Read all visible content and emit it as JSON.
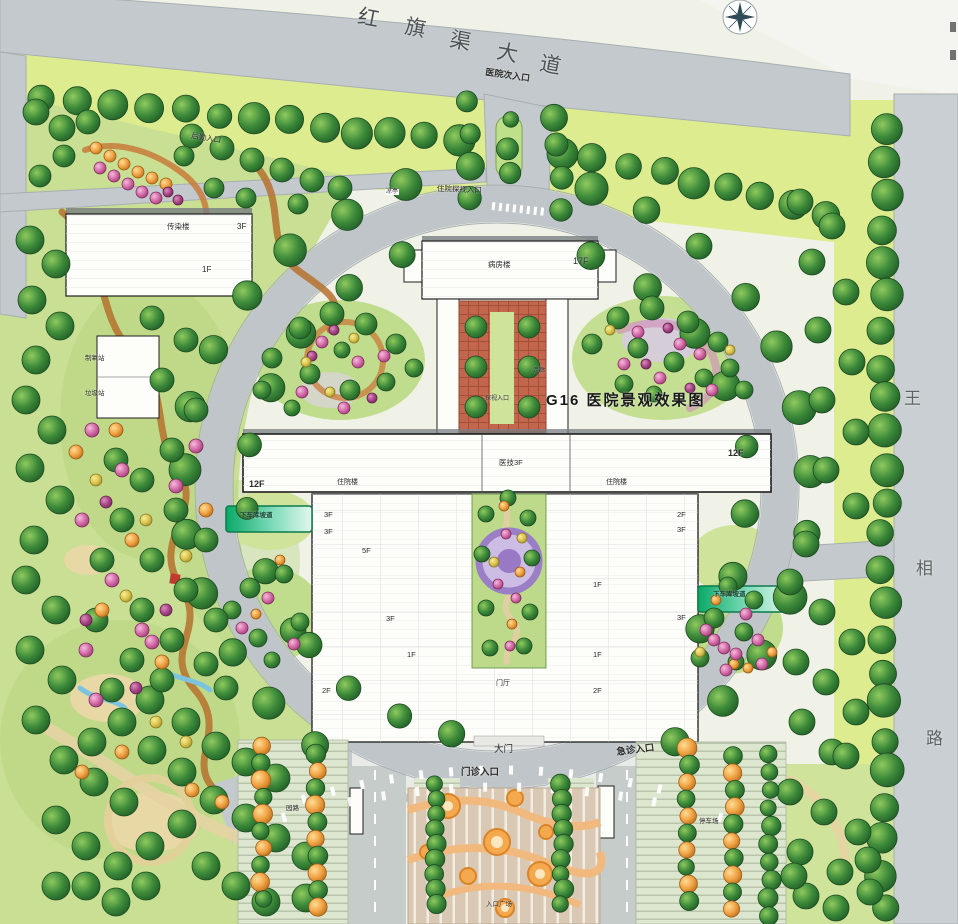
{
  "plan": {
    "watermark_text": "G16 医院景观效果图",
    "north_road_name": "红旗渠大道",
    "east_road_name": "王相路"
  },
  "icons": [
    {
      "name": "compass-rose-icon"
    },
    {
      "name": "tree-icon"
    },
    {
      "name": "shrub-icon"
    }
  ],
  "colors": {
    "lawn": "#ddec8e",
    "park_green": "#c9df93",
    "road_grey": "#c3c9cc",
    "ring_grey": "#bfc5c8",
    "courtyard_terracotta": "#c2674d",
    "ramp_teal": "#0aa968",
    "tree_green": "#3d8a3a",
    "tree_orange": "#f0a244",
    "shrub_pink": "#d46aa8",
    "feature_purple": "#9a7fc6",
    "plaza_tan": "#d9c9b4"
  },
  "labels": {
    "road_names": [
      {
        "id": "hongqiqu-char-1",
        "t": "红",
        "x": 360,
        "y": 6,
        "fs": 21,
        "rot": 11,
        "c": "#4c5155"
      },
      {
        "id": "hongqiqu-char-2",
        "t": "旗",
        "x": 407,
        "y": 16,
        "fs": 21,
        "rot": 11,
        "c": "#4c5155"
      },
      {
        "id": "hongqiqu-char-3",
        "t": "渠",
        "x": 452,
        "y": 29,
        "fs": 21,
        "rot": 11,
        "c": "#4c5155"
      },
      {
        "id": "hongqiqu-char-4",
        "t": "大",
        "x": 499,
        "y": 41,
        "fs": 21,
        "rot": 11,
        "c": "#4c5155"
      },
      {
        "id": "hongqiqu-char-5",
        "t": "道",
        "x": 542,
        "y": 53,
        "fs": 21,
        "rot": 11,
        "c": "#4c5155"
      },
      {
        "id": "wangxiang-char-1",
        "t": "王",
        "x": 904,
        "y": 390,
        "fs": 17,
        "c": "#5d6266"
      },
      {
        "id": "wangxiang-char-2",
        "t": "相",
        "x": 916,
        "y": 560,
        "fs": 17,
        "c": "#5d6266"
      },
      {
        "id": "wangxiang-char-3",
        "t": "路",
        "x": 926,
        "y": 730,
        "fs": 17,
        "c": "#5d6266"
      }
    ],
    "entrances": [
      {
        "id": "hospital-secondary-entrance",
        "t": "医院次入口",
        "x": 486,
        "y": 68,
        "fs": 9,
        "rot": 8,
        "b": 1
      },
      {
        "id": "inpatient-visit-entrance",
        "t": "住院探视入口",
        "x": 437,
        "y": 185,
        "fs": 7.5,
        "rot": 2
      },
      {
        "id": "service-entrance",
        "t": "后勤入口",
        "x": 192,
        "y": 132,
        "fs": 7.5,
        "rot": 9
      },
      {
        "id": "main-gate",
        "t": "大门",
        "x": 494,
        "y": 745,
        "fs": 9.5
      },
      {
        "id": "outpatient-entrance",
        "t": "门诊入口",
        "x": 461,
        "y": 768,
        "fs": 9.5,
        "b": 1
      },
      {
        "id": "emergency-entrance",
        "t": "急诊入口",
        "x": 616,
        "y": 748,
        "fs": 9.5,
        "rot": -7,
        "b": 1
      },
      {
        "id": "courtyard-visit-entrance",
        "t": "探视入口",
        "x": 485,
        "y": 396,
        "fs": 6
      }
    ],
    "buildings": [
      {
        "id": "infectious-building",
        "t": "传染楼",
        "x": 167,
        "y": 223,
        "fs": 7.5
      },
      {
        "id": "infectious-floors",
        "t": "3F",
        "x": 237,
        "y": 223,
        "fs": 8
      },
      {
        "id": "infectious-floors-b",
        "t": "1F",
        "x": 202,
        "y": 266,
        "fs": 8
      },
      {
        "id": "oxygen-station",
        "t": "制氧站",
        "x": 85,
        "y": 356,
        "fs": 6.5
      },
      {
        "id": "garbage-station",
        "t": "垃圾站",
        "x": 85,
        "y": 391,
        "fs": 6.5
      },
      {
        "id": "ward-tower",
        "t": "病房楼",
        "x": 488,
        "y": 261,
        "fs": 7.5
      },
      {
        "id": "ward-tower-floors",
        "t": "17F",
        "x": 573,
        "y": 257,
        "fs": 9
      },
      {
        "id": "corridor",
        "t": "连廊",
        "x": 533,
        "y": 368,
        "fs": 6
      },
      {
        "id": "west-wing-floors",
        "t": "12F",
        "x": 249,
        "y": 480,
        "fs": 9,
        "b": 1
      },
      {
        "id": "inpatient-west",
        "t": "住院楼",
        "x": 337,
        "y": 479,
        "fs": 7
      },
      {
        "id": "medtech-block",
        "t": "医技3F",
        "x": 499,
        "y": 459,
        "fs": 7.5
      },
      {
        "id": "inpatient-east",
        "t": "住院楼",
        "x": 606,
        "y": 479,
        "fs": 7
      },
      {
        "id": "east-wing-floors",
        "t": "12F",
        "x": 728,
        "y": 449,
        "fs": 9,
        "b": 1
      },
      {
        "id": "entry-hall",
        "t": "门厅",
        "x": 496,
        "y": 680,
        "fs": 7
      }
    ],
    "floors": [
      {
        "t": "3F",
        "x": 324,
        "y": 511,
        "fs": 7.5
      },
      {
        "t": "3F",
        "x": 324,
        "y": 528,
        "fs": 7.5
      },
      {
        "t": "5F",
        "x": 362,
        "y": 547,
        "fs": 7.5
      },
      {
        "t": "3F",
        "x": 386,
        "y": 615,
        "fs": 7.5
      },
      {
        "t": "1F",
        "x": 407,
        "y": 651,
        "fs": 7.5
      },
      {
        "t": "2F",
        "x": 322,
        "y": 687,
        "fs": 7.5
      },
      {
        "t": "2F",
        "x": 677,
        "y": 511,
        "fs": 7.5
      },
      {
        "t": "3F",
        "x": 677,
        "y": 526,
        "fs": 7.5
      },
      {
        "t": "1F",
        "x": 593,
        "y": 581,
        "fs": 7.5
      },
      {
        "t": "3F",
        "x": 677,
        "y": 614,
        "fs": 7.5
      },
      {
        "t": "1F",
        "x": 593,
        "y": 651,
        "fs": 7.5
      },
      {
        "t": "2F",
        "x": 593,
        "y": 687,
        "fs": 7.5
      }
    ],
    "site": [
      {
        "id": "garage-ramp-west",
        "t": "下车库坡道",
        "x": 240,
        "y": 513,
        "fs": 6.5,
        "c": "#0a3d2a",
        "b": 1
      },
      {
        "id": "garage-ramp-east",
        "t": "下车库坡道",
        "x": 713,
        "y": 592,
        "fs": 6.5,
        "c": "#0a3d2a",
        "b": 1
      },
      {
        "id": "garden-path",
        "t": "园路",
        "x": 286,
        "y": 806,
        "fs": 6.5
      },
      {
        "id": "parking-lot",
        "t": "停车场",
        "x": 699,
        "y": 819,
        "fs": 6.5
      },
      {
        "id": "entry-plaza",
        "t": "入口广场",
        "x": 486,
        "y": 902,
        "fs": 6.5
      },
      {
        "id": "pavilion",
        "t": "凉亭",
        "x": 385,
        "y": 189,
        "fs": 6,
        "bg": "#ffffff"
      }
    ],
    "watermark": [
      {
        "id": "sheet-watermark",
        "t": "G16 医院景观效果图",
        "x": 546,
        "y": 393,
        "fs": 15,
        "b": 1,
        "ls": 2,
        "c": "#191919"
      }
    ]
  }
}
